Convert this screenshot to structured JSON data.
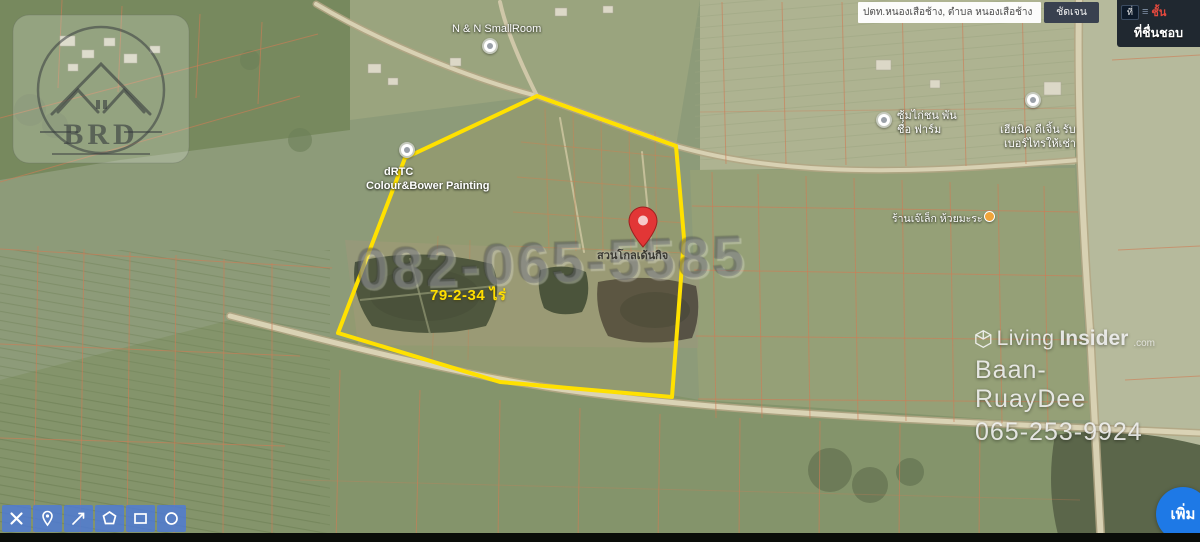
{
  "search": {
    "query": "ปตท.หนองเสือช้าง, ตำบล หนองเสือช้าง อำเภอ",
    "clear_button": "ชัดเจน"
  },
  "layers_panel": {
    "chip": "ที่",
    "layers_label": "ชั้น",
    "favorites_label": "ที่ชื่นชอบ"
  },
  "parcel": {
    "area_label": "79-2-34 ไร่",
    "outline_color": "#ffe100"
  },
  "pin": {
    "color": "#e23636",
    "place_label": "สวนโกลเด้นกิจ"
  },
  "poi": {
    "smallroom": "N & N SmallRoom",
    "rtc_line1": "dRTC",
    "rtc_line2": "Colour&Bower Painting",
    "chicken_line1": "ซุ้มไก่ชน พัน",
    "chicken_line2": "ชื่อ ฟาร์ม",
    "right_shop_line1": "เฮียนิค ดีเจิ้น รับ",
    "right_shop_line2": "เบอร์ไทรให้เช่า",
    "melon_shop": "ร้านเจ๊เล็ก ห้วยมะระ"
  },
  "watermarks": {
    "brd": "BRD",
    "phone_large": "082-065-5585",
    "brand_light": "Living",
    "brand_bold": "Insider",
    "brand_tld": ".com",
    "brand_name": "Baan-RuayDee",
    "brand_phone": "065-253-9924"
  },
  "toolbar": {
    "color": "#4d7ad8",
    "buttons": [
      "edit-cross-tools-icon",
      "pin-tool-icon",
      "measure-arrow-icon",
      "polygon-tool-icon",
      "rectangle-tool-icon",
      "circle-tool-icon"
    ]
  },
  "add_button": {
    "label": "เพิ่ม",
    "color": "#1e79e6"
  }
}
